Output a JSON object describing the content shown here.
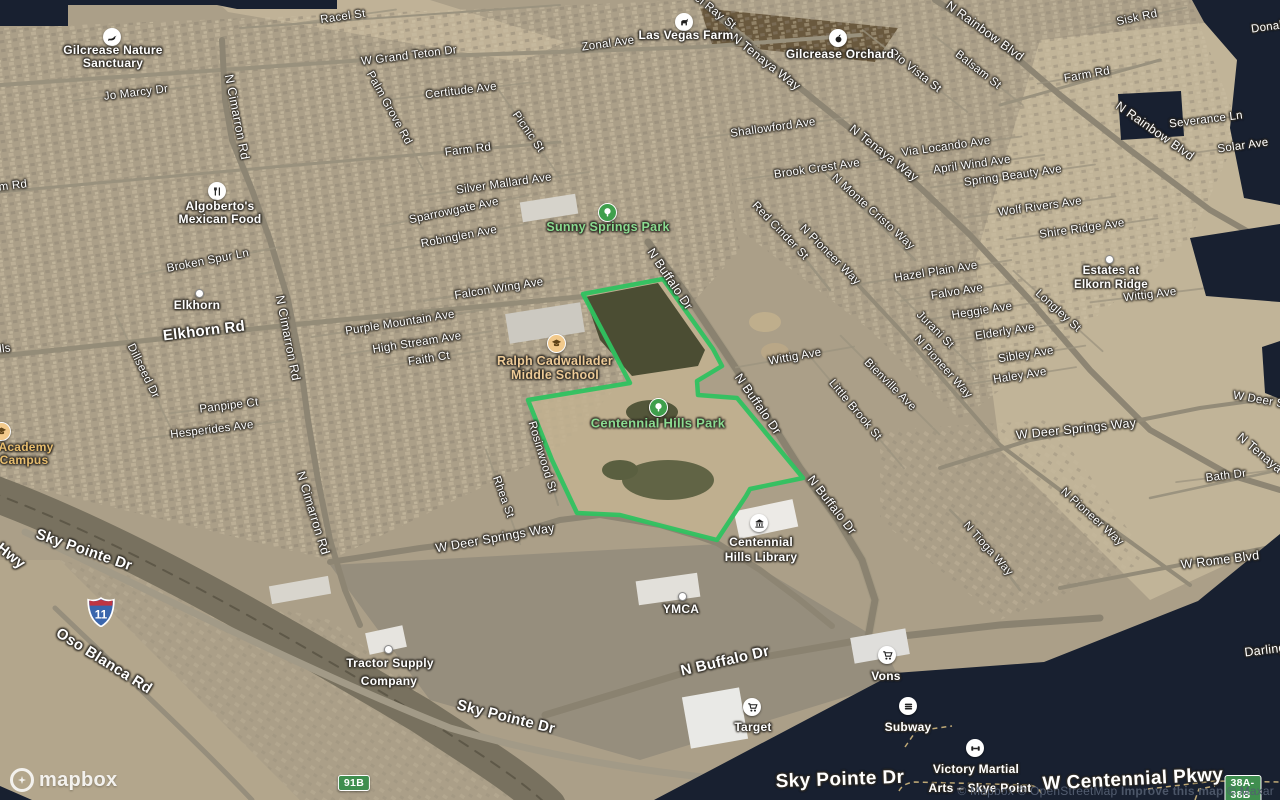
{
  "colors": {
    "park_outline": "#2fc260",
    "void": "#182030",
    "shield_green": "#3f8e4f",
    "interstate_blue": "#3a66ad",
    "interstate_red": "#bf3542"
  },
  "attribution": {
    "items": [
      "© Mapbox",
      "© OpenStreetMap",
      "Improve this map",
      "© Maxar"
    ]
  },
  "logo": {
    "text": "mapbox"
  },
  "park_boundary": [
    [
      583,
      294
    ],
    [
      663,
      279
    ],
    [
      713,
      349
    ],
    [
      722,
      366
    ],
    [
      697,
      381
    ],
    [
      698,
      395
    ],
    [
      737,
      398
    ],
    [
      803,
      478
    ],
    [
      750,
      489
    ],
    [
      746,
      496
    ],
    [
      717,
      540
    ],
    [
      670,
      528
    ],
    [
      620,
      515
    ],
    [
      577,
      513
    ],
    [
      552,
      460
    ],
    [
      528,
      400
    ],
    [
      630,
      383
    ]
  ],
  "shields": [
    {
      "name": "interstate-11-shield",
      "text": "11",
      "x": 101,
      "y": 612,
      "type": "interstate"
    },
    {
      "name": "route-91b-shield",
      "text": "91B",
      "x": 354,
      "y": 783,
      "type": "green"
    },
    {
      "name": "exit-38a-38b-shield",
      "text": "38A-38B",
      "x": 1243,
      "y": 789,
      "type": "green"
    }
  ],
  "labels": [
    {
      "n": "road-label-racel-st",
      "t": "Racel St",
      "x": 343,
      "y": 17,
      "r": -8,
      "k": "r1",
      "road": 1
    },
    {
      "n": "road-label-zonal-ave",
      "t": "Zonal Ave",
      "x": 608,
      "y": 44,
      "r": -8,
      "k": "r1",
      "road": 1
    },
    {
      "n": "road-label-el-ray-st",
      "t": "el Ray St",
      "x": 715,
      "y": 12,
      "r": 38,
      "k": "r1",
      "road": 1
    },
    {
      "n": "road-label-w-grand-teton-dr",
      "t": "W Grand Teton Dr",
      "x": 409,
      "y": 56,
      "r": -7,
      "k": "r1"
    },
    {
      "n": "road-label-jo-marcy-dr",
      "t": "Jo Marcy Dr",
      "x": 136,
      "y": 93,
      "r": -7,
      "k": "r1",
      "road": 1
    },
    {
      "n": "road-label-n-cimarron-rd-1",
      "t": "N Cimarron Rd",
      "x": 237,
      "y": 117,
      "r": 79,
      "k": "r2"
    },
    {
      "n": "road-label-palm-grove-rd",
      "t": "Palm Grove Rd",
      "x": 389,
      "y": 108,
      "r": 61,
      "k": "r1",
      "road": 1
    },
    {
      "n": "road-label-certitude-ave",
      "t": "Certitude Ave",
      "x": 461,
      "y": 91,
      "r": -7,
      "k": "r1",
      "road": 1
    },
    {
      "n": "road-label-picnic-st",
      "t": "Picnic St",
      "x": 528,
      "y": 132,
      "r": 55,
      "k": "r1",
      "road": 1
    },
    {
      "n": "road-label-farm-rd-mid",
      "t": "Farm Rd",
      "x": 468,
      "y": 150,
      "r": -7,
      "k": "r1"
    },
    {
      "n": "road-label-farm-rd-left",
      "t": "Farm Rd",
      "x": 4,
      "y": 187,
      "r": -7,
      "k": "r1"
    },
    {
      "n": "road-label-silver-mallard-ave",
      "t": "Silver Mallard Ave",
      "x": 504,
      "y": 184,
      "r": -8,
      "k": "r1",
      "road": 1
    },
    {
      "n": "road-label-n-tenaya-way-1",
      "t": "N Tenaya Way",
      "x": 766,
      "y": 62,
      "r": 38,
      "k": "r2"
    },
    {
      "n": "road-label-rio-vista-st",
      "t": "Rio Vista St",
      "x": 915,
      "y": 71,
      "r": 38,
      "k": "r1",
      "road": 1
    },
    {
      "n": "road-label-balsam-st",
      "t": "Balsam St",
      "x": 978,
      "y": 70,
      "r": 38,
      "k": "r1",
      "road": 1
    },
    {
      "n": "road-label-n-rainbow-blvd-1",
      "t": "N Rainbow Blvd",
      "x": 985,
      "y": 31,
      "r": 36,
      "k": "r2"
    },
    {
      "n": "road-label-sisk-rd",
      "t": "Sisk Rd",
      "x": 1137,
      "y": 18,
      "r": -12,
      "k": "r1",
      "road": 1
    },
    {
      "n": "road-label-donald",
      "t": "Donald",
      "x": 1270,
      "y": 27,
      "r": -8,
      "k": "r1"
    },
    {
      "n": "road-label-farm-rd-right",
      "t": "Farm Rd",
      "x": 1087,
      "y": 75,
      "r": -10,
      "k": "r1",
      "road": 1
    },
    {
      "n": "road-label-shallowford-ave",
      "t": "Shallowford Ave",
      "x": 773,
      "y": 128,
      "r": -8,
      "k": "r1",
      "road": 1
    },
    {
      "n": "road-label-n-tenaya-way-2",
      "t": "N Tenaya Way",
      "x": 884,
      "y": 153,
      "r": 38,
      "k": "r2"
    },
    {
      "n": "road-label-via-locando-ave",
      "t": "Via Locando Ave",
      "x": 946,
      "y": 147,
      "r": -8,
      "k": "r1",
      "road": 1
    },
    {
      "n": "road-label-brook-crest-ave",
      "t": "Brook Crest Ave",
      "x": 817,
      "y": 169,
      "r": -8,
      "k": "r1",
      "road": 1
    },
    {
      "n": "road-label-april-wind-ave",
      "t": "April Wind Ave",
      "x": 972,
      "y": 165,
      "r": -8,
      "k": "r1",
      "road": 1
    },
    {
      "n": "road-label-spring-beauty-ave",
      "t": "Spring Beauty Ave",
      "x": 1013,
      "y": 176,
      "r": -8,
      "k": "r1",
      "road": 1
    },
    {
      "n": "road-label-n-monte-cristo-way",
      "t": "N Monte Cristo Way",
      "x": 873,
      "y": 212,
      "r": 42,
      "k": "r1"
    },
    {
      "n": "road-label-red-cinder-st",
      "t": "Red Cinder St",
      "x": 780,
      "y": 231,
      "r": 46,
      "k": "r1"
    },
    {
      "n": "road-label-n-pioneer-way-1",
      "t": "N Pioneer Way",
      "x": 830,
      "y": 255,
      "r": 45,
      "k": "r1"
    },
    {
      "n": "road-label-n-rainbow-blvd-2",
      "t": "N Rainbow Blvd",
      "x": 1155,
      "y": 131,
      "r": 35,
      "k": "r2"
    },
    {
      "n": "road-label-severance-ln",
      "t": "Severance Ln",
      "x": 1206,
      "y": 120,
      "r": -7,
      "k": "r1",
      "road": 1
    },
    {
      "n": "road-label-solar-ave",
      "t": "Solar Ave",
      "x": 1243,
      "y": 146,
      "r": -8,
      "k": "r1",
      "road": 1
    },
    {
      "n": "road-label-wolf-rivers-ave",
      "t": "Wolf Rivers Ave",
      "x": 1040,
      "y": 207,
      "r": -8,
      "k": "r1",
      "road": 1
    },
    {
      "n": "road-label-shire-ridge-ave",
      "t": "Shire Ridge Ave",
      "x": 1082,
      "y": 229,
      "r": -8,
      "k": "r1",
      "road": 1
    },
    {
      "n": "road-label-hazel-plain-ave",
      "t": "Hazel Plain Ave",
      "x": 936,
      "y": 272,
      "r": -9,
      "k": "r1",
      "road": 1
    },
    {
      "n": "road-label-falvo-ave",
      "t": "Falvo Ave",
      "x": 957,
      "y": 292,
      "r": -9,
      "k": "r1",
      "road": 1
    },
    {
      "n": "road-label-heggie-ave",
      "t": "Heggie Ave",
      "x": 982,
      "y": 311,
      "r": -9,
      "k": "r1",
      "road": 1
    },
    {
      "n": "road-label-jurani-st",
      "t": "Jurani St",
      "x": 935,
      "y": 330,
      "r": 45,
      "k": "r1",
      "road": 1
    },
    {
      "n": "road-label-longley-st",
      "t": "Longley St",
      "x": 1058,
      "y": 311,
      "r": 42,
      "k": "r1",
      "road": 1
    },
    {
      "n": "road-label-elderly-ave",
      "t": "Elderly Ave",
      "x": 1005,
      "y": 332,
      "r": -9,
      "k": "r1",
      "road": 1
    },
    {
      "n": "road-label-sibley-ave",
      "t": "Sibley Ave",
      "x": 1026,
      "y": 355,
      "r": -9,
      "k": "r1",
      "road": 1
    },
    {
      "n": "road-label-haley-ave",
      "t": "Haley Ave",
      "x": 1020,
      "y": 376,
      "r": -9,
      "k": "r1",
      "road": 1
    },
    {
      "n": "road-label-n-pioneer-way-2",
      "t": "N Pioneer Way",
      "x": 943,
      "y": 367,
      "r": 48,
      "k": "r1"
    },
    {
      "n": "road-label-bienville-ave",
      "t": "Bienville Ave",
      "x": 890,
      "y": 385,
      "r": 45,
      "k": "r1",
      "road": 1
    },
    {
      "n": "road-label-little-brook-st",
      "t": "Little Brook St",
      "x": 855,
      "y": 410,
      "r": 50,
      "k": "r1",
      "road": 1
    },
    {
      "n": "road-label-wittig-ave-1",
      "t": "Wittig Ave",
      "x": 795,
      "y": 357,
      "r": -10,
      "k": "r1",
      "road": 1
    },
    {
      "n": "road-label-wittig-ave-2",
      "t": "Wittig Ave",
      "x": 1150,
      "y": 295,
      "r": -7,
      "k": "r1",
      "road": 1
    },
    {
      "n": "road-label-sparrowgate-ave",
      "t": "Sparrowgate Ave",
      "x": 454,
      "y": 211,
      "r": -12,
      "k": "r1",
      "road": 1
    },
    {
      "n": "road-label-robinglen-ave",
      "t": "Robinglen Ave",
      "x": 459,
      "y": 237,
      "r": -11,
      "k": "r1",
      "road": 1
    },
    {
      "n": "road-label-falcon-wing-ave",
      "t": "Falcon Wing Ave",
      "x": 499,
      "y": 289,
      "r": -9,
      "k": "r1",
      "road": 1
    },
    {
      "n": "road-label-n-buffalo-dr-1",
      "t": "N Buffalo Dr",
      "x": 670,
      "y": 279,
      "r": 56,
      "k": "r2"
    },
    {
      "n": "road-label-purple-mountain-ave",
      "t": "Purple Mountain Ave",
      "x": 400,
      "y": 323,
      "r": -9,
      "k": "r1",
      "road": 1
    },
    {
      "n": "road-label-high-stream-ave",
      "t": "High Stream Ave",
      "x": 417,
      "y": 343,
      "r": -9,
      "k": "r1",
      "road": 1
    },
    {
      "n": "road-label-faith-ct",
      "t": "Faith Ct",
      "x": 429,
      "y": 359,
      "r": -9,
      "k": "r1",
      "road": 1
    },
    {
      "n": "road-label-broken-spur-ln",
      "t": "Broken Spur Ln",
      "x": 208,
      "y": 261,
      "r": -11,
      "k": "r1",
      "road": 1
    },
    {
      "n": "road-label-elkhorn-rd",
      "t": "Elkhorn Rd",
      "x": 204,
      "y": 331,
      "r": -7,
      "k": "r3"
    },
    {
      "n": "road-label-n-cimarron-rd-2",
      "t": "N Cimarron Rd",
      "x": 288,
      "y": 338,
      "r": 79,
      "k": "r2"
    },
    {
      "n": "road-label-dillseed-dr",
      "t": "Dillseed Dr",
      "x": 143,
      "y": 371,
      "r": 64,
      "k": "r1",
      "road": 1
    },
    {
      "n": "road-label-panpipe-ct",
      "t": "Panpipe Ct",
      "x": 229,
      "y": 406,
      "r": -7,
      "k": "r1",
      "road": 1
    },
    {
      "n": "road-label-hesperides-ave",
      "t": "Hesperides Ave",
      "x": 212,
      "y": 430,
      "r": -7,
      "k": "r1",
      "road": 1
    },
    {
      "n": "road-label-hills-fragment",
      "t": "lls",
      "x": 5,
      "y": 349,
      "r": -7,
      "k": "r1"
    },
    {
      "n": "road-label-n-buffalo-dr-2",
      "t": "N Buffalo Dr",
      "x": 758,
      "y": 404,
      "r": 55,
      "k": "r2"
    },
    {
      "n": "road-label-rosinwood-st",
      "t": "Rosinwood St",
      "x": 542,
      "y": 457,
      "r": 73,
      "k": "r1"
    },
    {
      "n": "road-label-rhea-st",
      "t": "Rhea St",
      "x": 503,
      "y": 497,
      "r": 70,
      "k": "r1",
      "road": 1
    },
    {
      "n": "road-label-n-cimarron-rd-3",
      "t": "N Cimarron Rd",
      "x": 313,
      "y": 513,
      "r": 73,
      "k": "r2"
    },
    {
      "n": "road-label-w-deer-springs-way-1",
      "t": "W Deer Springs Way",
      "x": 495,
      "y": 538,
      "r": -10,
      "k": "r2"
    },
    {
      "n": "road-label-w-deer-springs-way-2",
      "t": "W Deer Springs Way",
      "x": 1076,
      "y": 429,
      "r": -6,
      "k": "r2"
    },
    {
      "n": "road-label-w-deer-fragment",
      "t": "W Deer Spr",
      "x": 1264,
      "y": 401,
      "r": 10,
      "k": "r1"
    },
    {
      "n": "road-label-n-tenaya-fragment",
      "t": "N Tenaya W",
      "x": 1266,
      "y": 458,
      "r": 40,
      "k": "r2"
    },
    {
      "n": "road-label-bath-dr",
      "t": "Bath Dr",
      "x": 1226,
      "y": 476,
      "r": -7,
      "k": "r1",
      "road": 1
    },
    {
      "n": "road-label-n-pioneer-way-3",
      "t": "N Pioneer Way",
      "x": 1092,
      "y": 517,
      "r": 42,
      "k": "r1"
    },
    {
      "n": "road-label-n-buffalo-dr-3",
      "t": "N Buffalo Dr",
      "x": 832,
      "y": 505,
      "r": 52,
      "k": "r2"
    },
    {
      "n": "road-label-n-tioga-way",
      "t": "N Tioga Way",
      "x": 988,
      "y": 549,
      "r": 48,
      "k": "r1"
    },
    {
      "n": "road-label-w-rome-blvd",
      "t": "W Rome Blvd",
      "x": 1220,
      "y": 560,
      "r": -7,
      "k": "r2"
    },
    {
      "n": "road-label-darling-fragment",
      "t": "Darling",
      "x": 1265,
      "y": 650,
      "r": -7,
      "k": "r2"
    },
    {
      "n": "road-label-sky-pointe-dr-upper",
      "t": "Sky Pointe Dr",
      "x": 84,
      "y": 550,
      "r": 19,
      "k": "r3"
    },
    {
      "n": "road-label-hwy-fragment",
      "t": "Hwy",
      "x": 11,
      "y": 556,
      "r": 38,
      "k": "r3"
    },
    {
      "n": "road-label-oso-blanca-rd",
      "t": "Oso Blanca Rd",
      "x": 104,
      "y": 661,
      "r": 32,
      "k": "r3"
    },
    {
      "n": "road-label-sky-pointe-dr-mid",
      "t": "Sky Pointe Dr",
      "x": 506,
      "y": 717,
      "r": 14,
      "k": "r3"
    },
    {
      "n": "road-label-n-buffalo-dr-bottom",
      "t": "N Buffalo Dr",
      "x": 725,
      "y": 661,
      "r": -13,
      "k": "r3"
    },
    {
      "n": "road-label-sky-pointe-dr-big",
      "t": "Sky Pointe Dr",
      "x": 840,
      "y": 780,
      "r": -2,
      "k": "r4"
    },
    {
      "n": "road-label-w-centennial-pkwy",
      "t": "W Centennial Pkwy",
      "x": 1133,
      "y": 780,
      "r": -3,
      "k": "r4"
    }
  ],
  "pois": [
    {
      "n": "poi-gilcrease-nature-sanctuary",
      "icon": "bird",
      "circle": "c-white",
      "ix": 112,
      "iy": 37,
      "k": "poi",
      "lines": [
        {
          "t": "Gilcrease Nature",
          "x": 113,
          "y": 50
        },
        {
          "t": "Sanctuary",
          "x": 113,
          "y": 63
        }
      ]
    },
    {
      "n": "poi-las-vegas-farm",
      "icon": "horse",
      "circle": "c-white",
      "ix": 684,
      "iy": 22,
      "k": "poi",
      "lines": [
        {
          "t": "Las Vegas Farm",
          "x": 686,
          "y": 35
        }
      ]
    },
    {
      "n": "poi-gilcrease-orchard",
      "icon": "apple",
      "circle": "c-white",
      "ix": 838,
      "iy": 38,
      "k": "poi",
      "lines": [
        {
          "t": "Gilcrease Orchard",
          "x": 840,
          "y": 54
        }
      ]
    },
    {
      "n": "poi-algobertos-mexican-food",
      "icon": "restaurant",
      "circle": "c-white",
      "ix": 217,
      "iy": 191,
      "k": "poi",
      "lines": [
        {
          "t": "Algoberto's",
          "x": 220,
          "y": 206
        },
        {
          "t": "Mexican Food",
          "x": 220,
          "y": 219
        }
      ]
    },
    {
      "n": "poi-sunny-springs-park",
      "icon": "tree",
      "circle": "c-green",
      "ix": 607,
      "iy": 212,
      "k": "park",
      "lines": [
        {
          "t": "Sunny Springs Park",
          "x": 608,
          "y": 227
        }
      ]
    },
    {
      "n": "poi-ralph-cadwallader-middle-school",
      "icon": "school",
      "circle": "c-tan",
      "ix": 556,
      "iy": 343,
      "k": "school",
      "lines": [
        {
          "t": "Ralph Cadwallader",
          "x": 555,
          "y": 361
        },
        {
          "t": "Middle School",
          "x": 555,
          "y": 375
        }
      ]
    },
    {
      "n": "poi-centennial-hills-park",
      "icon": "tree",
      "circle": "c-green",
      "ix": 658,
      "iy": 407,
      "k": "park-big",
      "lines": [
        {
          "t": "Centennial Hills Park",
          "x": 658,
          "y": 423
        }
      ]
    },
    {
      "n": "poi-elkhorn",
      "icon": "dot",
      "circle": "c-dot",
      "ix": 198,
      "iy": 292,
      "k": "poi",
      "lines": [
        {
          "t": "Elkhorn",
          "x": 197,
          "y": 305
        }
      ]
    },
    {
      "n": "poi-estates-at-elkorn-ridge",
      "icon": "dot",
      "circle": "c-dot",
      "ix": 1108,
      "iy": 258,
      "k": "poi-sm",
      "lines": [
        {
          "t": "Estates at",
          "x": 1111,
          "y": 271
        },
        {
          "t": "Elkorn Ridge",
          "x": 1111,
          "y": 285
        }
      ]
    },
    {
      "n": "poi-academy-campus",
      "icon": "school",
      "circle": "c-tan",
      "ix": 1,
      "iy": 431,
      "k": "academy",
      "lines": [
        {
          "t": "Academy",
          "x": 26,
          "y": 447
        },
        {
          "t": "Campus",
          "x": 24,
          "y": 460
        }
      ]
    },
    {
      "n": "poi-centennial-hills-library",
      "icon": "library",
      "circle": "c-white",
      "ix": 759,
      "iy": 523,
      "k": "poi",
      "lines": [
        {
          "t": "Centennial",
          "x": 761,
          "y": 542
        },
        {
          "t": "Hills Library",
          "x": 761,
          "y": 557
        }
      ]
    },
    {
      "n": "poi-ymca",
      "icon": "dot",
      "circle": "c-dot",
      "ix": 681,
      "iy": 595,
      "k": "poi",
      "lines": [
        {
          "t": "YMCA",
          "x": 681,
          "y": 609
        }
      ]
    },
    {
      "n": "poi-tractor-supply-company",
      "icon": "dot",
      "circle": "c-dot",
      "ix": 387,
      "iy": 648,
      "k": "poi",
      "lines": [
        {
          "t": "Tractor Supply",
          "x": 390,
          "y": 663
        },
        {
          "t": "Company",
          "x": 389,
          "y": 681
        }
      ]
    },
    {
      "n": "poi-target",
      "icon": "cart",
      "circle": "c-white",
      "ix": 752,
      "iy": 707,
      "k": "poi",
      "lines": [
        {
          "t": "Target",
          "x": 753,
          "y": 727
        }
      ]
    },
    {
      "n": "poi-vons",
      "icon": "cart",
      "circle": "c-white",
      "ix": 887,
      "iy": 655,
      "k": "poi",
      "lines": [
        {
          "t": "Vons",
          "x": 886,
          "y": 676
        }
      ]
    },
    {
      "n": "poi-subway",
      "icon": "sandwich",
      "circle": "c-white",
      "ix": 908,
      "iy": 706,
      "k": "poi",
      "lines": [
        {
          "t": "Subway",
          "x": 908,
          "y": 727
        }
      ]
    },
    {
      "n": "poi-victory-martial-arts",
      "icon": "dumbbell",
      "circle": "c-white",
      "ix": 975,
      "iy": 748,
      "k": "poi",
      "lines": [
        {
          "t": "Victory Martial",
          "x": 976,
          "y": 769
        },
        {
          "t": "Arts – Skye Point",
          "x": 980,
          "y": 788
        }
      ]
    }
  ]
}
